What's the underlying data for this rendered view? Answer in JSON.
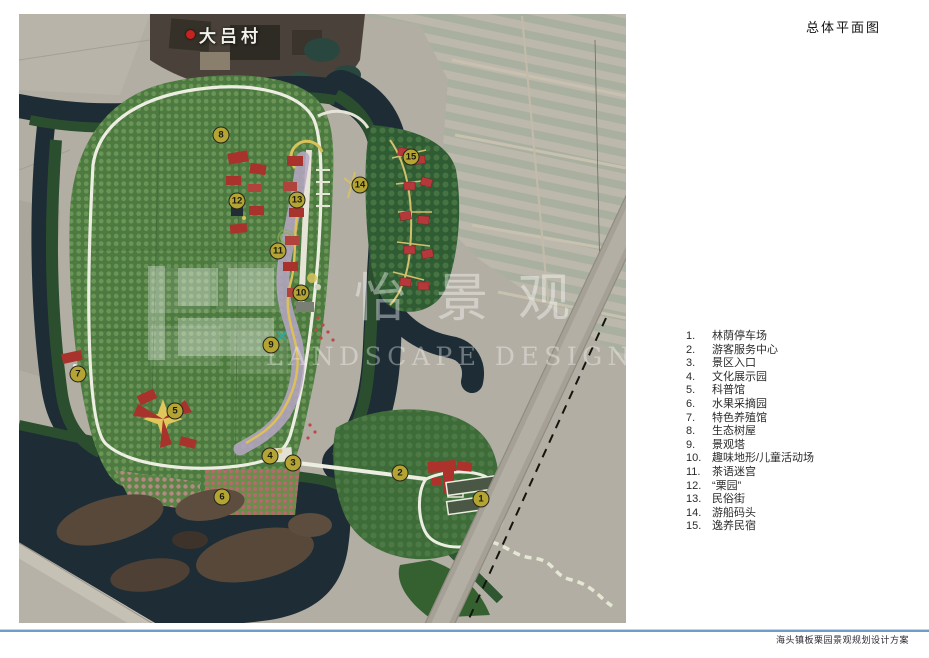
{
  "sheet": {
    "title": "总体平面图",
    "footer_caption": "海头镇板栗园景观规划设计方案"
  },
  "map": {
    "village_label": "大吕村",
    "watermark_cn": "怡景观",
    "watermark_en": "LANDSCAPE DESIGN",
    "markers": [
      "1",
      "2",
      "3",
      "4",
      "5",
      "6",
      "7",
      "8",
      "9",
      "10",
      "11",
      "12",
      "13",
      "14",
      "15"
    ]
  },
  "legend": {
    "items": [
      {
        "num": "1.",
        "label": "林荫停车场"
      },
      {
        "num": "2.",
        "label": "游客服务中心"
      },
      {
        "num": "3.",
        "label": "景区入口"
      },
      {
        "num": "4.",
        "label": "文化展示园"
      },
      {
        "num": "5.",
        "label": "科普馆"
      },
      {
        "num": "6.",
        "label": "水果采摘园"
      },
      {
        "num": "7.",
        "label": "特色养殖馆"
      },
      {
        "num": "8.",
        "label": "生态树屋"
      },
      {
        "num": "9.",
        "label": "景观塔"
      },
      {
        "num": "10.",
        "label": "趣味地形/儿童活动场"
      },
      {
        "num": "11.",
        "label": "茶语迷宫"
      },
      {
        "num": "12.",
        "label": "“栗园”"
      },
      {
        "num": "13.",
        "label": "民俗街"
      },
      {
        "num": "14.",
        "label": "游船码头"
      },
      {
        "num": "15.",
        "label": "逸养民宿"
      }
    ]
  },
  "colors": {
    "marker_fill": "#b3a433",
    "water": "#1d2c35",
    "site_green": "#4d7a40",
    "accent_red": "#a8332c",
    "footer_line": "#6f9cc9"
  }
}
